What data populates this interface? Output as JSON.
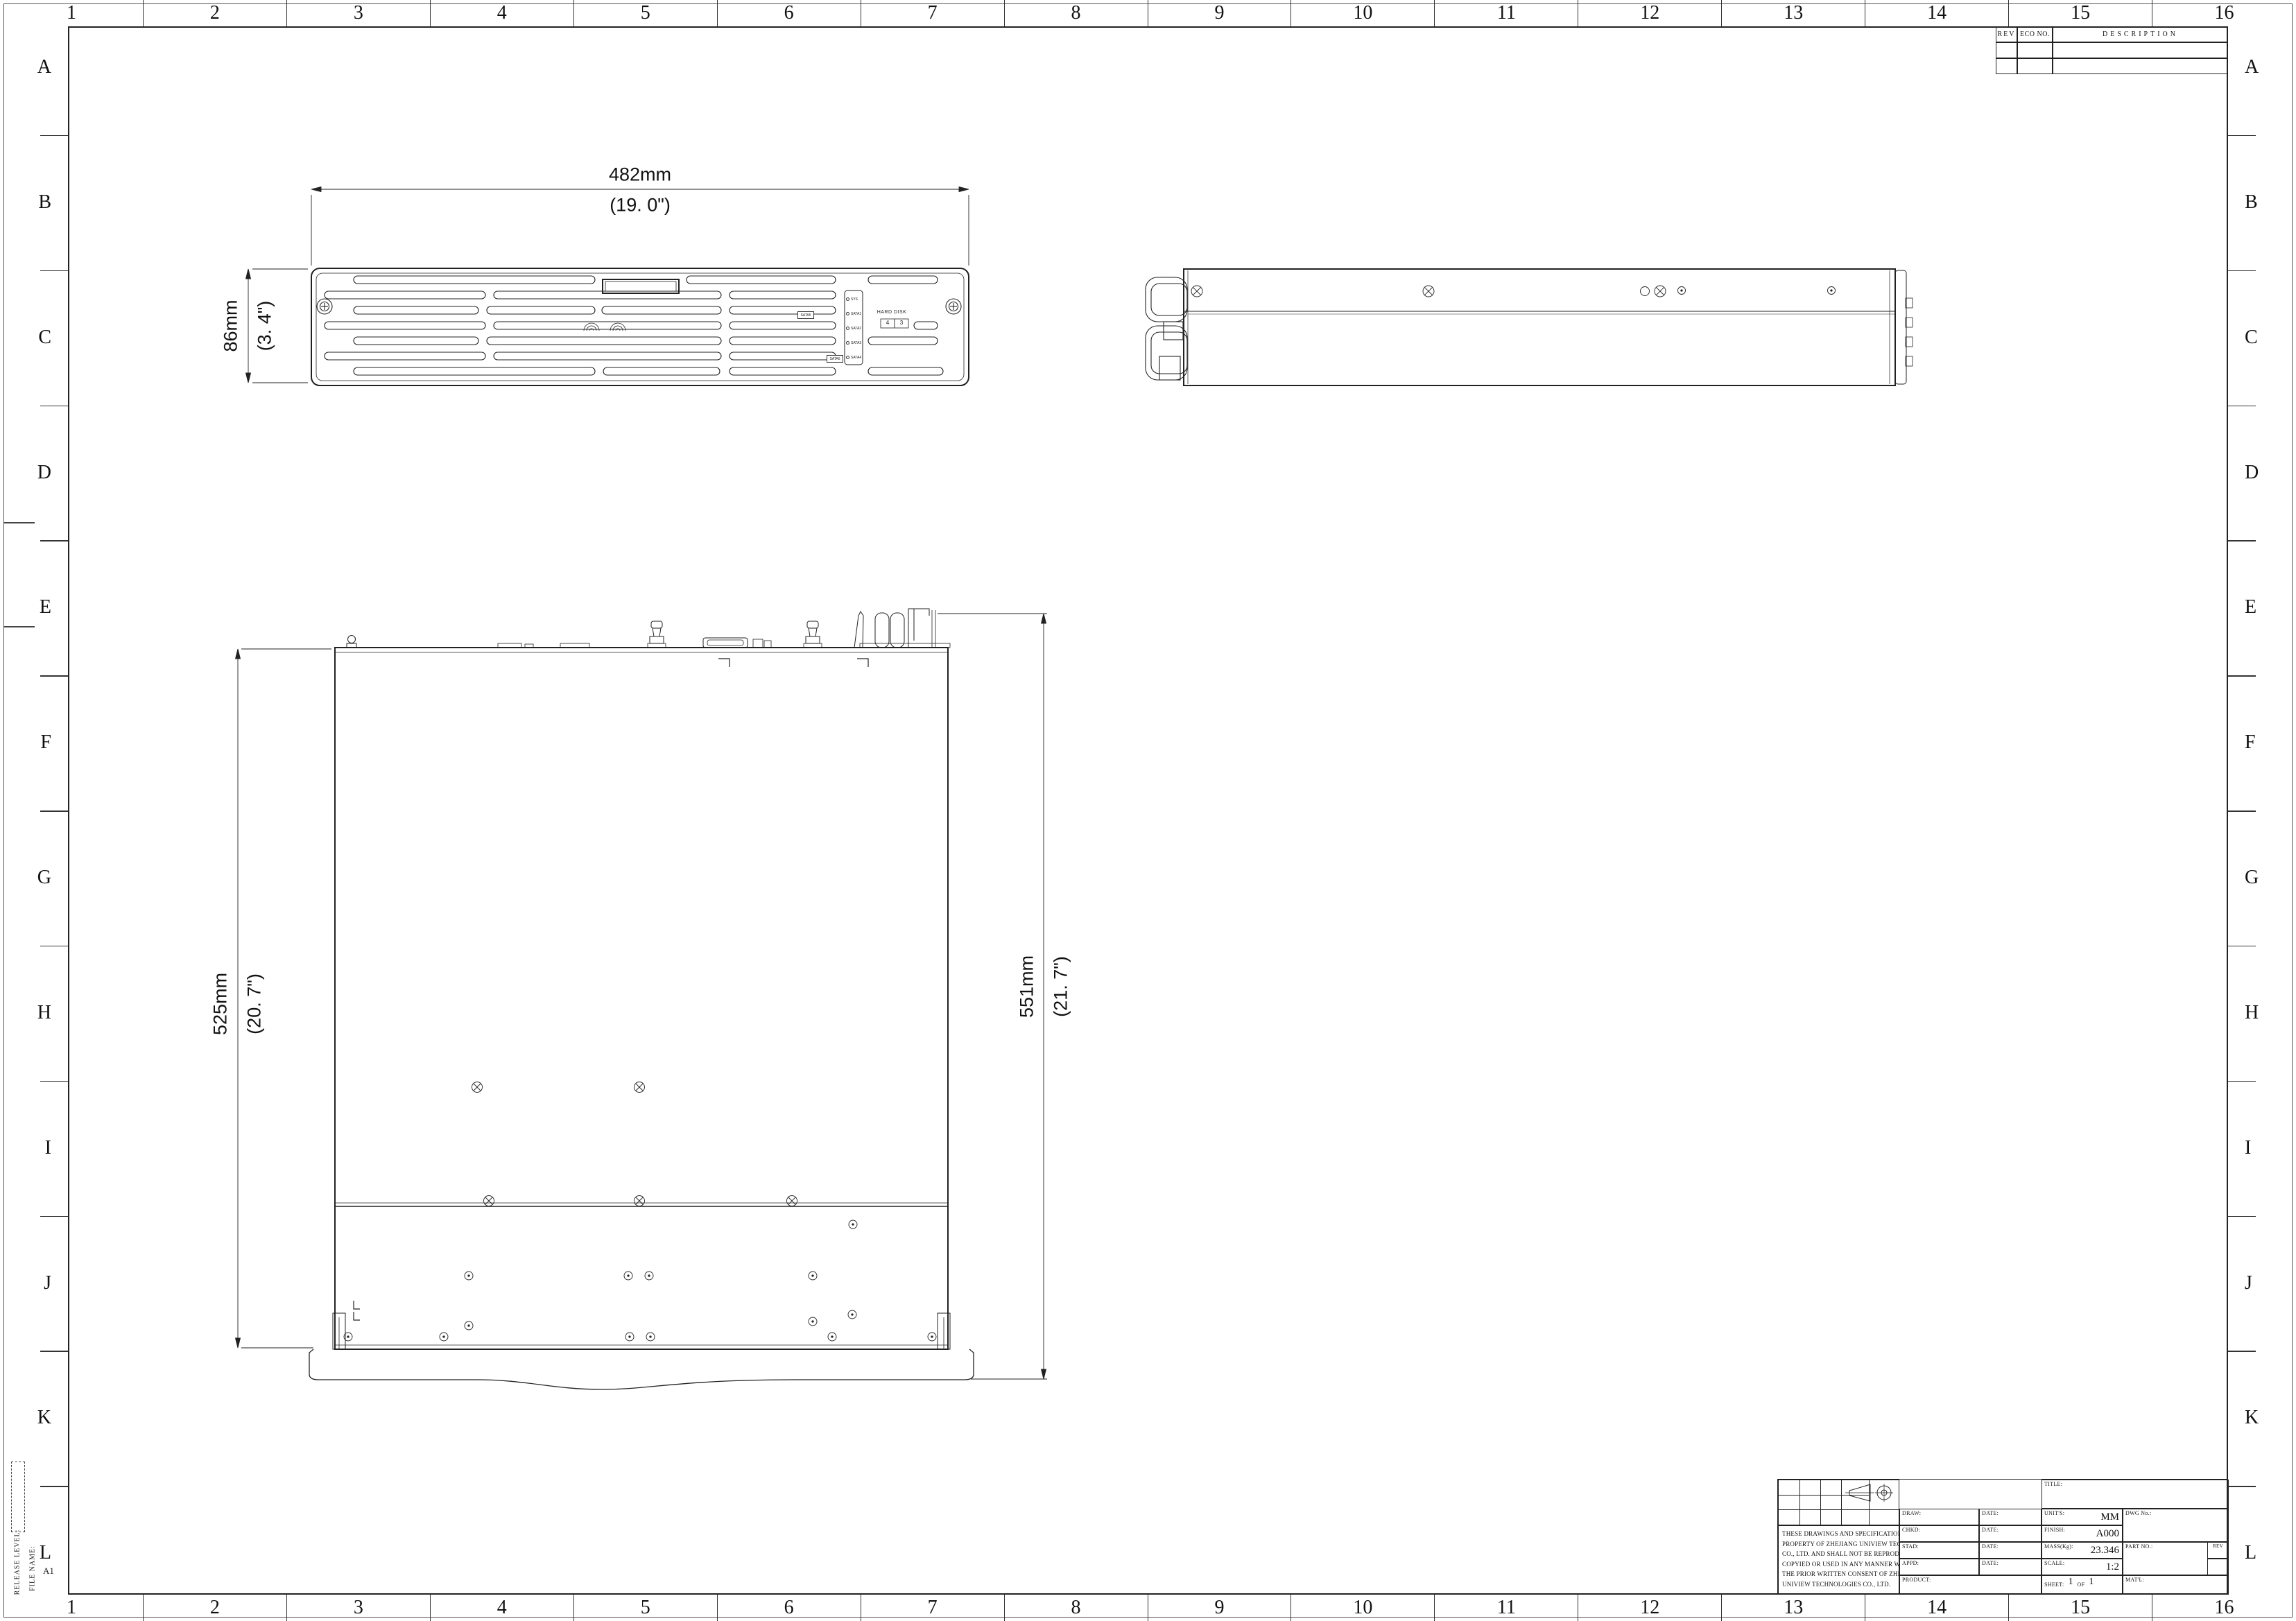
{
  "border": {
    "columns": [
      "1",
      "2",
      "3",
      "4",
      "5",
      "6",
      "7",
      "8",
      "9",
      "10",
      "11",
      "12",
      "13",
      "14",
      "15",
      "16"
    ],
    "rows": [
      "A",
      "B",
      "C",
      "D",
      "E",
      "F",
      "G",
      "H",
      "I",
      "J",
      "K",
      "L"
    ]
  },
  "margin": {
    "release_level_label": "RELEASE LEVEL:",
    "file_name_label": "FILE NAME:",
    "sheet_size": "A1"
  },
  "revision_table": {
    "rev_header": "REV",
    "eco_header": "ECO NO.",
    "description_header": "DESCRIPTION"
  },
  "dimensions": {
    "width_mm": "482mm",
    "width_in": "(19. 0\")",
    "height_mm": "86mm",
    "height_in": "(3. 4\")",
    "body_depth_mm": "525mm",
    "body_depth_in": "(20. 7\")",
    "total_depth_mm": "551mm",
    "total_depth_in": "(21. 7\")"
  },
  "front_view": {
    "hard_disk_label": "HARD DISK",
    "disk_numbers": [
      "4",
      "3"
    ],
    "led_labels": [
      "SYS",
      "SATA1",
      "SATA2",
      "SATA3",
      "SATA4"
    ],
    "tray_stickers": [
      "SATA5",
      "SATA6"
    ]
  },
  "title_block": {
    "title_label": "TITLE:",
    "draw_label": "DRAW:",
    "chkd_label": "CHKD:",
    "stad_label": "STAD:",
    "appd_label": "APPD:",
    "date_label": "DATE:",
    "product_label": "PRODUCT:",
    "units_label": "UNIT'S:",
    "units_value": "MM",
    "finish_label": "FINISH:",
    "finish_value": "A000",
    "mass_label": "MASS(Kg):",
    "mass_value": "23.346",
    "scale_label": "SCALE:",
    "scale_value": "1:2",
    "sheet_label": "SHEET:",
    "sheet_num": "1",
    "sheet_of": "OF",
    "sheet_total": "1",
    "dwg_label": "DWG No.:",
    "part_label": "PART NO.:",
    "rev_label": "REV",
    "matl_label": "MAT'L:",
    "notice_lines": [
      "THESE DRAWINGS AND SPECIFICATION ARE THE",
      "PROPERTY OF ZHEJIANG UNIVIEW TECHNOLOGIES",
      "CO., LTD. AND SHALL NOT BE REPRODUCED",
      "COPYIED OR USED IN ANY MANNER WITHOUT",
      "THE PRIOR WRITTEN CONSENT OF ZHEJIANG",
      "UNIVIEW TECHNOLOGIES CO., LTD."
    ]
  }
}
